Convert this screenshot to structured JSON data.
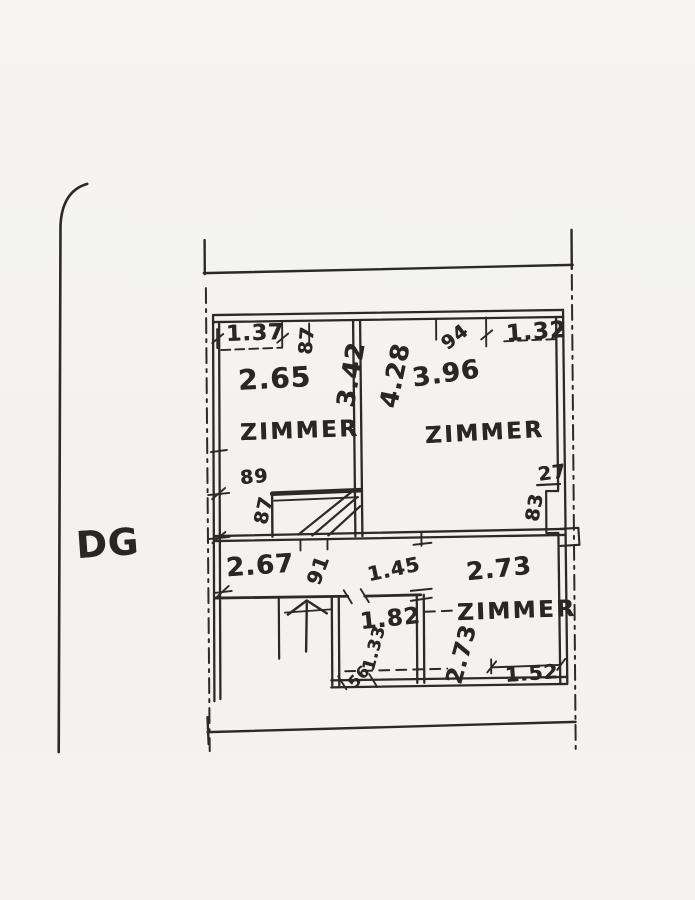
{
  "document_type": "hand-drawn floor plan sketch",
  "floor_label": "DG",
  "rooms": {
    "top_left": {
      "name": "ZIMMER",
      "width": "2.65",
      "depth": "3.42"
    },
    "top_right": {
      "name": "ZIMMER",
      "width": "3.96",
      "depth": "4.28"
    },
    "bottom_right": {
      "name": "ZIMMER",
      "width": "2.73",
      "depth": "2.73"
    },
    "bottom_middle": {
      "width": "1.82",
      "depth": "1.33"
    }
  },
  "dimensions": {
    "top_window_left": "1.37",
    "top_door_left": "87",
    "top_door_right": "94",
    "top_window_right": "1.32",
    "left_wall_upper": "89",
    "left_wall_lower": "87",
    "duct_width": "27",
    "duct_height": "83",
    "hallway_length": "2.67",
    "hallway_door": "91",
    "hallway_opening": "1.45",
    "bottom_window_right": "1.52",
    "small_door": "56"
  },
  "colors": {
    "paper": "#f4f3f0",
    "ink": "#2d2a26"
  }
}
